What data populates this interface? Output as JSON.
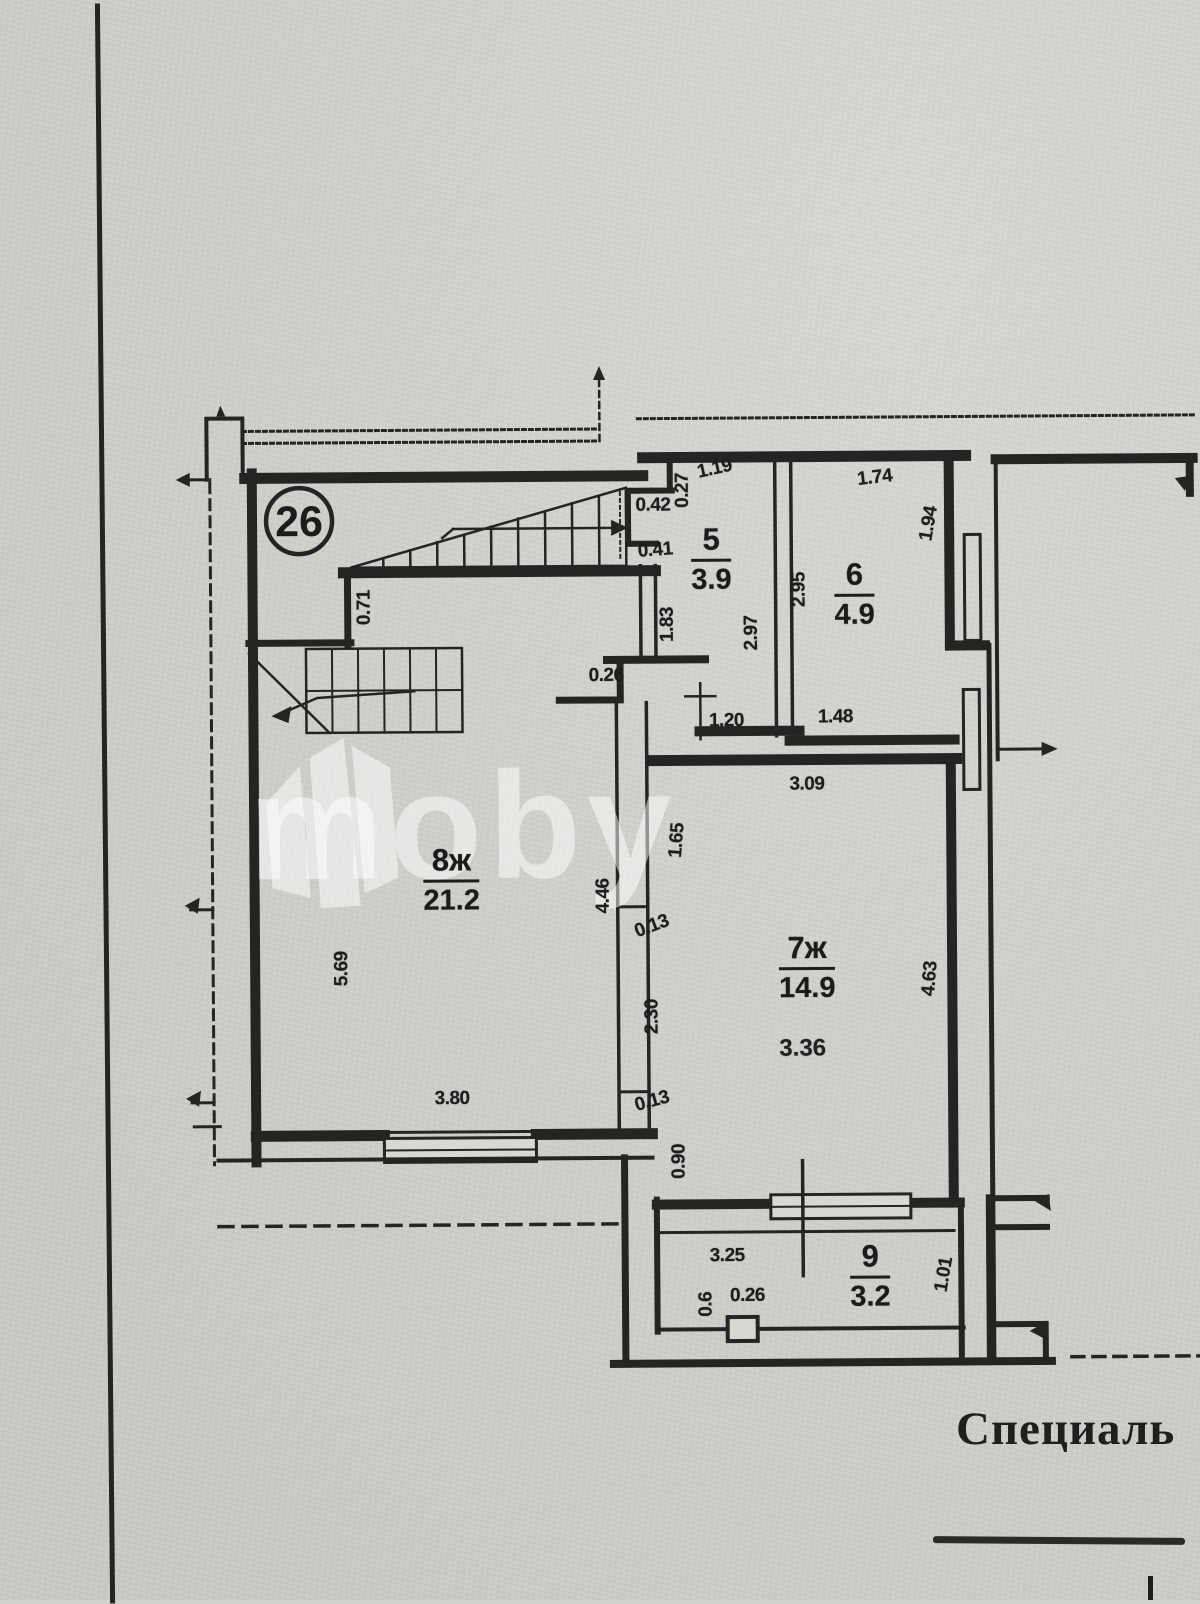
{
  "unit": {
    "number": "26"
  },
  "watermark": {
    "text": "moby"
  },
  "footer": {
    "text": "Специаль"
  },
  "colors": {
    "paper": "#d2d1ce",
    "ink": "#242424",
    "watermark": "rgba(255,255,255,0.5)"
  },
  "rooms": [
    {
      "key": "5",
      "label": "5",
      "area": "3.9"
    },
    {
      "key": "6",
      "label": "6",
      "area": "4.9"
    },
    {
      "key": "7ж",
      "label": "7ж",
      "area": "14.9",
      "note": "3.36"
    },
    {
      "key": "8ж",
      "label": "8ж",
      "area": "21.2"
    },
    {
      "key": "9",
      "label": "9",
      "area": "3.2"
    }
  ],
  "dimensions": [
    {
      "text": "0.42",
      "x": 655,
      "y": 506,
      "rot": 0
    },
    {
      "text": "0.27",
      "x": 685,
      "y": 491,
      "rot": -90
    },
    {
      "text": "1.19",
      "x": 717,
      "y": 470,
      "rot": -12
    },
    {
      "text": "0.41",
      "x": 657,
      "y": 551,
      "rot": -4
    },
    {
      "text": "1.83",
      "x": 669,
      "y": 625,
      "rot": -90
    },
    {
      "text": "0.26",
      "x": 607,
      "y": 676,
      "rot": 0
    },
    {
      "text": "2.97",
      "x": 753,
      "y": 634,
      "rot": -90
    },
    {
      "text": "2.95",
      "x": 801,
      "y": 591,
      "rot": -90
    },
    {
      "text": "1.74",
      "x": 877,
      "y": 480,
      "rot": -6
    },
    {
      "text": "1.94",
      "x": 931,
      "y": 526,
      "rot": -80
    },
    {
      "text": "0.71",
      "x": 366,
      "y": 606,
      "rot": -90
    },
    {
      "text": "1.20",
      "x": 727,
      "y": 722,
      "rot": 0
    },
    {
      "text": "1.48",
      "x": 836,
      "y": 719,
      "rot": 0
    },
    {
      "text": "3.09",
      "x": 807,
      "y": 786,
      "rot": 0
    },
    {
      "text": "1.65",
      "x": 677,
      "y": 841,
      "rot": -85
    },
    {
      "text": "4.46",
      "x": 603,
      "y": 896,
      "rot": -90
    },
    {
      "text": "0.13",
      "x": 651,
      "y": 927,
      "rot": -20
    },
    {
      "text": "2.30",
      "x": 651,
      "y": 1017,
      "rot": -90
    },
    {
      "text": "0.13",
      "x": 650,
      "y": 1102,
      "rot": -15
    },
    {
      "text": "5.69",
      "x": 341,
      "y": 967,
      "rot": -90
    },
    {
      "text": "3.80",
      "x": 450,
      "y": 1098,
      "rot": 0
    },
    {
      "text": "4.63",
      "x": 929,
      "y": 981,
      "rot": -85
    },
    {
      "text": "0.90",
      "x": 677,
      "y": 1162,
      "rot": -90
    },
    {
      "text": "3.25",
      "x": 724,
      "y": 1257,
      "rot": 0
    },
    {
      "text": "0.26",
      "x": 744,
      "y": 1297,
      "rot": 0
    },
    {
      "text": "0.6",
      "x": 703,
      "y": 1305,
      "rot": -90
    },
    {
      "text": "1.01",
      "x": 941,
      "y": 1277,
      "rot": -80
    }
  ]
}
